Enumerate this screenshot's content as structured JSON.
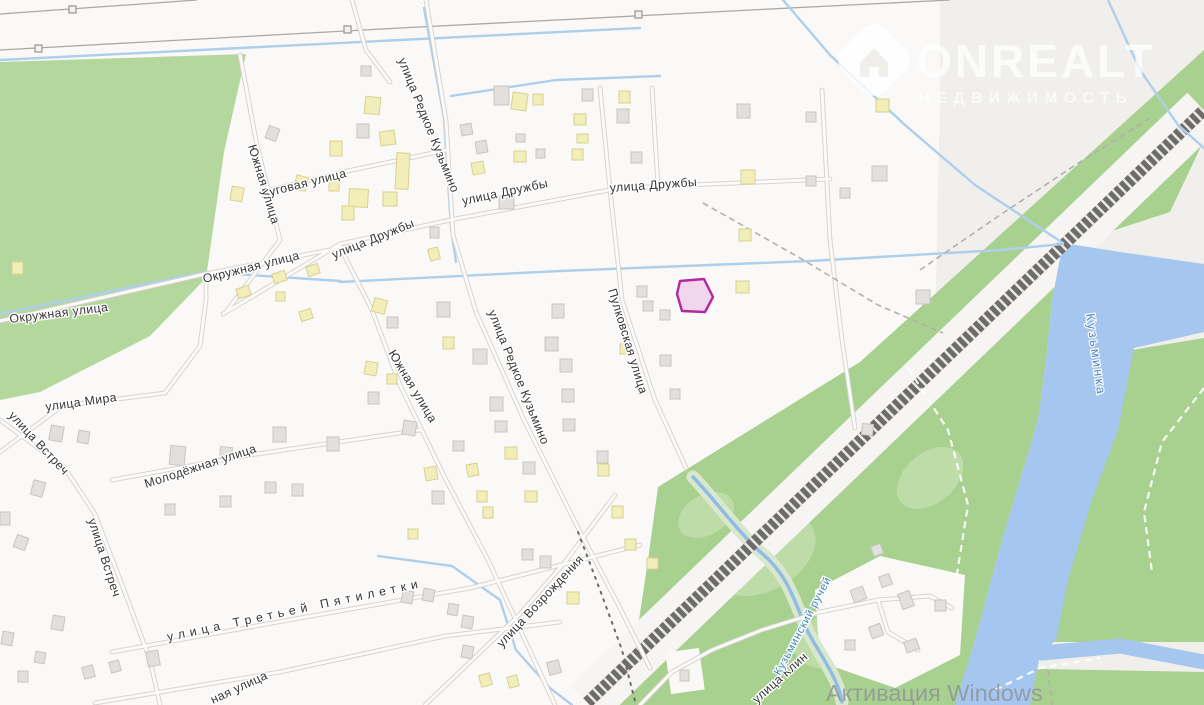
{
  "watermark": {
    "brand": "ONREALT",
    "subtitle": "НЕДВИЖИМОСТЬ"
  },
  "system_overlay": {
    "activation_text": "Активация Windows"
  },
  "map": {
    "street_labels": [
      {
        "text": "улица Редкое Кузьмино"
      },
      {
        "text": "Луговая улица"
      },
      {
        "text": "улица Дружбы"
      },
      {
        "text": "улица Дружбы"
      },
      {
        "text": "улица Дружбы"
      },
      {
        "text": "Окружная улица"
      },
      {
        "text": "Окружная улица"
      },
      {
        "text": "улица Мира"
      },
      {
        "text": "улица Встреч"
      },
      {
        "text": "улица Встреч"
      },
      {
        "text": "Южная улица"
      },
      {
        "text": "Южная улица"
      },
      {
        "text": "Молодёжная улица"
      },
      {
        "text": "улица Третьей Пятилетки"
      },
      {
        "text": "улица Возрождения"
      },
      {
        "text": "улица Редкое Кузьмино"
      },
      {
        "text": "Пулковская улица"
      },
      {
        "text": "улица Клин"
      },
      {
        "text": "ная улица"
      }
    ],
    "water_labels": [
      {
        "text": "Кузьминка"
      },
      {
        "text": "Кузьминский ручей"
      }
    ],
    "highlighted_parcel": {
      "stroke": "#b5279f",
      "fill": "#eccbe9"
    },
    "colors": {
      "field": "#f1efec",
      "residential": "#faf9f7",
      "green": "#b3d79c",
      "forest": "#a8d08f",
      "river": "#a5c6ef",
      "stream": "#aecfeb",
      "road_casing": "#d7d4d0",
      "railway": "#6e6c69",
      "parcel_stroke": "#b5279f",
      "parcel_fill": "#eccbe9",
      "label": "#363636",
      "water_label": "#4a7fc0",
      "activation": "#8f9398"
    }
  }
}
